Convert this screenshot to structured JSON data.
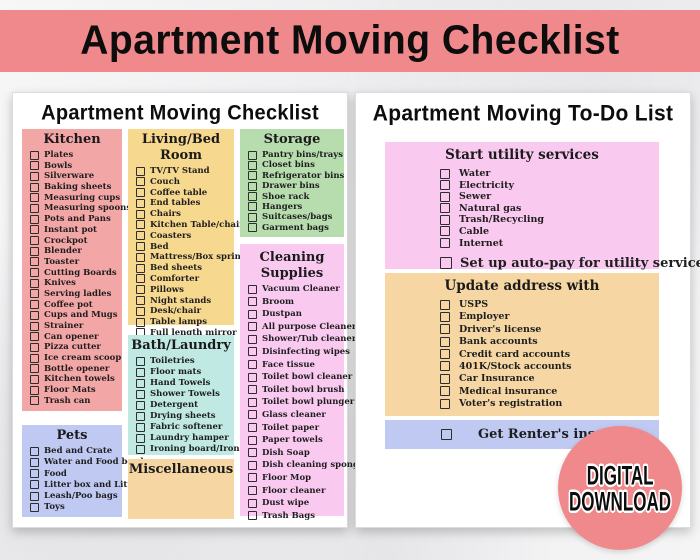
{
  "banner": {
    "title": "Apartment Moving Checklist"
  },
  "colors": {
    "banner_bg": "#f0898b",
    "kitchen_bg": "#f3a6a6",
    "living_bg": "#f6d88e",
    "storage_bg": "#b7dcae",
    "cleaning_bg": "#fac9f0",
    "bath_bg": "#c0e9e3",
    "pets_bg": "#bfc9f1",
    "misc_bg": "#f6d7a4",
    "utilities_bg": "#fac9f0",
    "address_bg": "#f6d7a4",
    "insurance_bg": "#bfc9f1",
    "badge_bg": "#f0898b"
  },
  "left_page": {
    "title": "Apartment Moving Checklist",
    "sections": {
      "kitchen": {
        "title": "Kitchen",
        "items": [
          "Plates",
          "Bowls",
          "Silverware",
          "Baking sheets",
          "Measuring cups",
          "Measuring spoons",
          "Pots and Pans",
          "Instant pot",
          "Crockpot",
          "Blender",
          "Toaster",
          "Cutting Boards",
          "Knives",
          "Serving ladles",
          "Coffee pot",
          "Cups and Mugs",
          "Strainer",
          "Can opener",
          "Pizza cutter",
          "Ice cream scoop",
          "Bottle opener",
          "Kitchen towels",
          "Floor Mats",
          "Trash can"
        ]
      },
      "living": {
        "title": "Living/Bed Room",
        "items": [
          "TV/TV Stand",
          "Couch",
          "Coffee table",
          "End tables",
          "Chairs",
          "Kitchen Table/chairs",
          "Coasters",
          "Bed",
          "Mattress/Box spring",
          "Bed sheets",
          "Comforter",
          "Pillows",
          "Night stands",
          "Desk/chair",
          "Table lamps",
          "Full length mirror"
        ]
      },
      "bath": {
        "title": "Bath/Laundry",
        "items": [
          "Toiletries",
          "Floor mats",
          "Hand Towels",
          "Shower Towels",
          "Detergent",
          "Drying sheets",
          "Fabric softener",
          "Laundry hamper",
          "Ironing board/Iron"
        ]
      },
      "misc": {
        "title": "Miscellaneous",
        "items": []
      },
      "storage": {
        "title": "Storage",
        "items": [
          "Pantry bins/trays",
          "Closet bins",
          "Refrigerator bins",
          "Drawer bins",
          "Shoe rack",
          "Hangers",
          "Suitcases/bags",
          "Garment bags"
        ]
      },
      "cleaning": {
        "title": "Cleaning Supplies",
        "items": [
          "Vacuum Cleaner",
          "Broom",
          "Dustpan",
          "All purpose Cleaner",
          "Shower/Tub cleaner",
          "Disinfecting wipes",
          "Face tissue",
          "Toilet bowl cleaner",
          "Toilet bowl brush",
          "Toilet bowl plunger",
          "Glass cleaner",
          "Toilet paper",
          "Paper towels",
          "Dish Soap",
          "Dish cleaning sponge",
          "Floor Mop",
          "Floor cleaner",
          "Dust wipe",
          "Trash Bags"
        ]
      },
      "pets": {
        "title": "Pets",
        "items": [
          "Bed and Crate",
          "Water and Food bowl",
          "Food",
          "Litter box and Litter",
          "Leash/Poo bags",
          "Toys"
        ]
      }
    }
  },
  "right_page": {
    "title": "Apartment Moving To-Do List",
    "sections": {
      "utilities": {
        "title": "Start utility services",
        "items": [
          "Water",
          "Electricity",
          "Sewer",
          "Natural gas",
          "Trash/Recycling",
          "Cable",
          "Internet"
        ],
        "footer": "Set up auto-pay for utility services"
      },
      "address": {
        "title": "Update address with",
        "items": [
          "USPS",
          "Employer",
          "Driver's license",
          "Bank accounts",
          "Credit card accounts",
          "401K/Stock accounts",
          "Car Insurance",
          "Medical insurance",
          "Voter's registration"
        ]
      },
      "insurance": {
        "title": "Get Renter's insurance"
      }
    }
  },
  "badge": {
    "line1": "DIGITAL",
    "line2": "DOWNLOAD"
  }
}
